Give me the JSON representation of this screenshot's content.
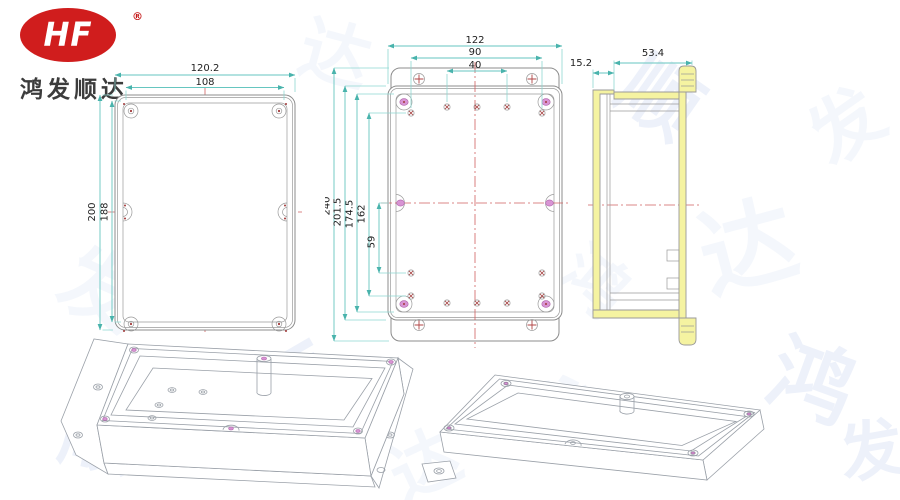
{
  "logo": {
    "monogram": "HF",
    "registered": "®",
    "company_name": "鸿发顺达"
  },
  "watermark": {
    "chars": [
      "鸿",
      "发",
      "顺",
      "达"
    ]
  },
  "drawing": {
    "lid_front_view": {
      "width_outer": "120.2",
      "width_inner": "108",
      "height_outer": "200",
      "height_inner": "188"
    },
    "base_plan_view": {
      "width_overall": "122",
      "hole_span_wide": "90",
      "hole_span_narrow": "40",
      "height_overall": "240",
      "height_body": "201.5",
      "height_inner": "174.5",
      "hole_span_vertical": "162",
      "hole_offset": "59"
    },
    "side_section_view": {
      "lid_depth": "15.2",
      "base_depth": "53.4"
    }
  },
  "colors": {
    "logo_red": "#d01d1d",
    "dimension_line": "#66c6c0",
    "centerline_red": "#d06060",
    "section_highlight_yellow": "#f5f3a1",
    "boss_magenta": "#d894d4",
    "drawing_line_gray": "#8c8c8c",
    "watermark_blue": "#dde6f6"
  }
}
